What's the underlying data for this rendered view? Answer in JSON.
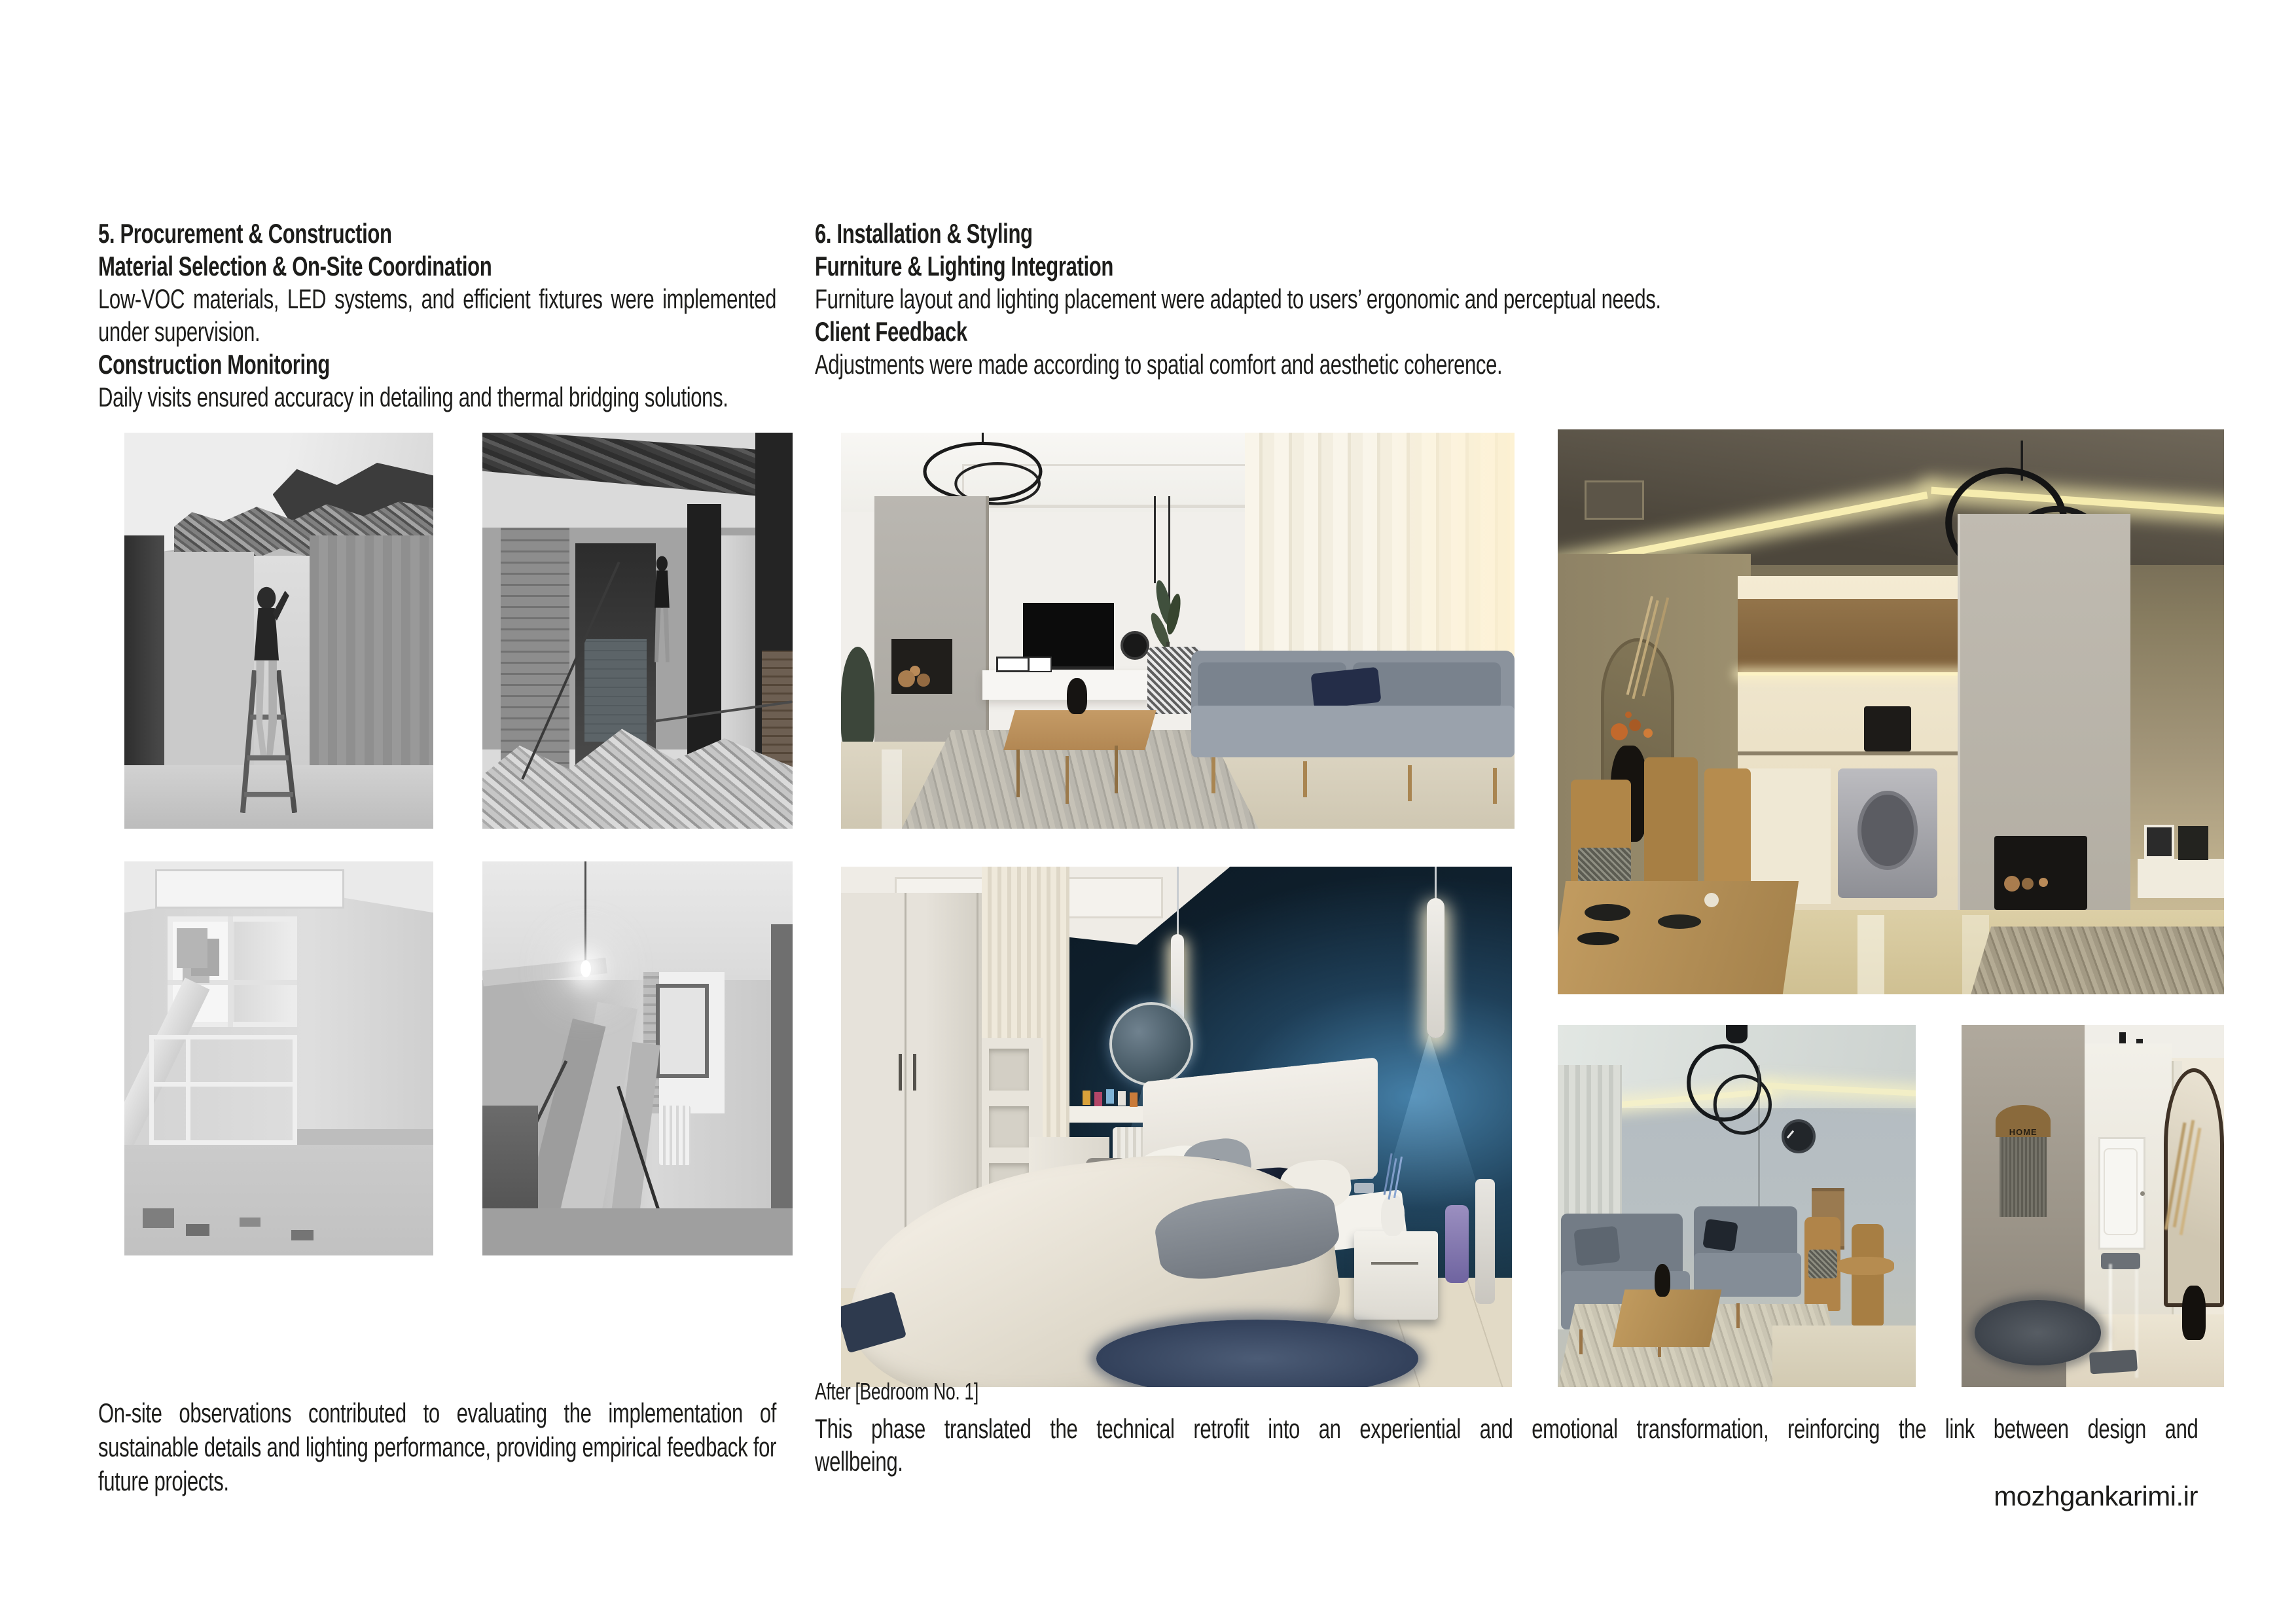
{
  "page": {
    "type": "interior-design portfolio page",
    "background": "#ffffff",
    "website": "mozhgankarimi.ir"
  },
  "sections": {
    "procurement": {
      "heading": "5. Procurement & Construction",
      "sub1": "Material Selection & On-Site Coordination",
      "body1": "Low-VOC materials, LED systems, and efficient fixtures were implemented under supervision.",
      "sub2": "Construction Monitoring",
      "body2": "Daily visits ensured accuracy in detailing and thermal bridging solutions.",
      "footer": "On-site observations contributed to evaluating the implementation of sustainable details and lighting performance, providing empirical feedback for future projects."
    },
    "installation": {
      "heading": "6. Installation & Styling",
      "sub1": "Furniture & Lighting Integration",
      "body1": "Furniture layout and lighting placement were adapted to users’ ergonomic and perceptual needs.",
      "sub2": "Client Feedback",
      "body2": "Adjustments were made according to spatial comfort and aesthetic coherence.",
      "caption": "After [Bedroom No. 1]",
      "footer_line1": "This phase translated the technical retrofit into an experiential and emotional transformation, reinforcing the link between design and",
      "footer_line2": "wellbeing."
    }
  },
  "photos": {
    "construction": [
      {
        "label": "Before (B/W) — ceiling demolition, worker on ladder in hallway"
      },
      {
        "label": "Before (B/W) — wall demolition with brick column and rubble"
      },
      {
        "label": "Before (B/W) — stripped kitchen with window and dismantled counter"
      },
      {
        "label": "Before (B/W) — bare room with hanging bulb and leaning panels"
      }
    ],
    "after": [
      {
        "label": "After — living room with marble wall, TV and gray sofa"
      },
      {
        "label": "After — kitchen and dining area with warm cove lighting"
      },
      {
        "label": "After — bedroom No. 1 with dark blue accent wall"
      },
      {
        "label": "After — sitting area with ring chandelier and gray sofas"
      },
      {
        "label": "After — hallway with arch mirror, round rug and HOME hanging",
        "sign": "HOME"
      }
    ]
  },
  "colors": {
    "text": "#1d1d1b",
    "background": "#ffffff",
    "bedroom_accent_dark": "#102230",
    "bedroom_glow_blue": "#3e7aa2",
    "kitchen_warm_olive": "#8a8157",
    "led_warm": "#f2e7a8",
    "sofa_gray": "#848d98",
    "wood": "#b1834f"
  }
}
